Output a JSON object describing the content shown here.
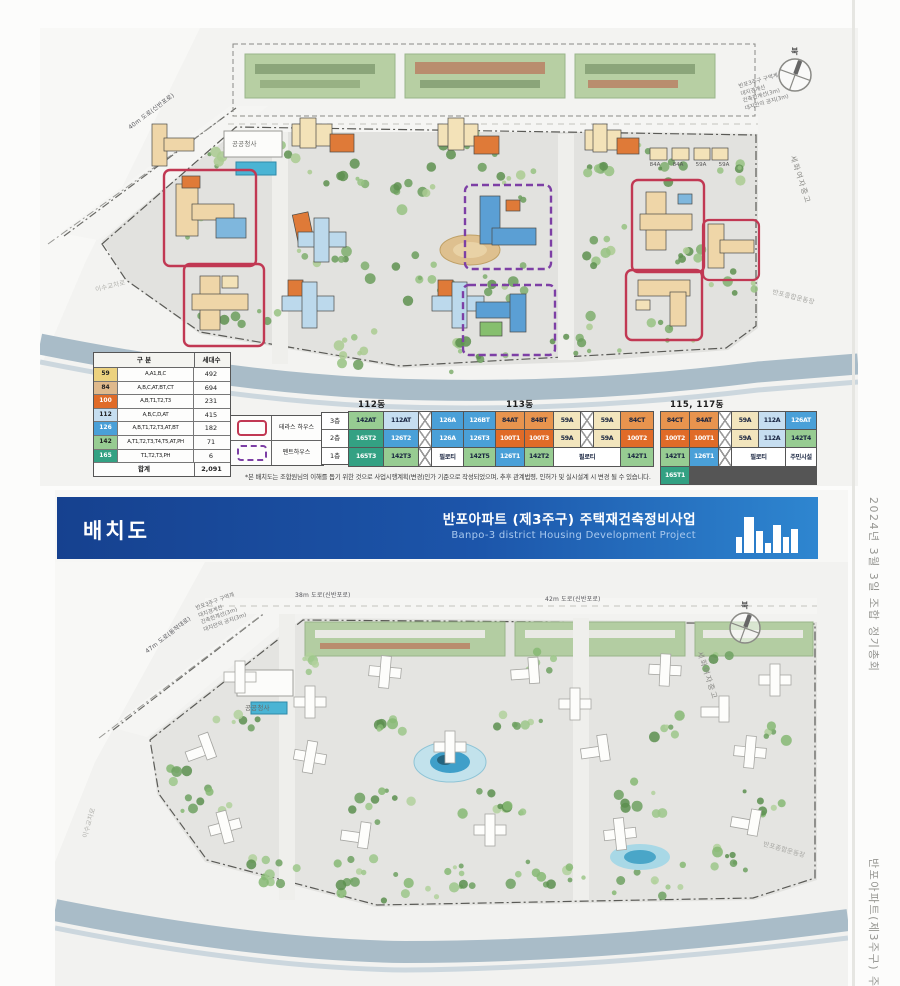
{
  "colors": {
    "terrace_outline": "#c13853",
    "penthouse_outline": "#7d3fa5",
    "banner_start": "#16418f",
    "banner_end": "#2e86d0",
    "unit_colors": {
      "59": "#f2e5bd",
      "84": "#e8944e",
      "100": "#e06b28",
      "112": "#c6def0",
      "126": "#4aa0d8",
      "142": "#97cc92",
      "165": "#33a183",
      "plain": "#ffffff"
    },
    "light_text_kinds": [
      "100",
      "126",
      "165"
    ]
  },
  "side_text": {
    "top": "2024년 3월 3일 조합 정기총회",
    "bottom": "반포아파트(제3주구) 주택재"
  },
  "top_plan": {
    "compass_label": "북",
    "labels": {
      "public_building": "공공청사",
      "road_diagonal": "40m 도로(신반포로)",
      "school": "세화여자중고",
      "interchange": "이수교차로",
      "sports": "반포종합운동장"
    },
    "mini_building_labels": [
      "84A",
      "84A",
      "59A",
      "59A"
    ],
    "annotations": [
      "반포3주구 구역계",
      "대지경계선",
      "건축한계선(3m)",
      "대지안의 공지(3m)"
    ],
    "legend_table": {
      "header_type": "구 분",
      "header_count": "세대수",
      "rows": [
        {
          "type": "59",
          "swatch": "#ecd27f",
          "desc": "A,A1,B,C",
          "count": "492",
          "light": false
        },
        {
          "type": "84",
          "swatch": "#dfb98c",
          "desc": "A,B,C,AT,BT,CT",
          "count": "694",
          "light": false
        },
        {
          "type": "100",
          "swatch": "#e06b28",
          "desc": "A,B,T1,T2,T3",
          "count": "231",
          "light": true
        },
        {
          "type": "112",
          "swatch": "#c6def0",
          "desc": "A,B,C,D,AT",
          "count": "415",
          "light": false
        },
        {
          "type": "126",
          "swatch": "#4aa0d8",
          "desc": "A,B,T1,T2,T3,AT,BT",
          "count": "182",
          "light": true
        },
        {
          "type": "142",
          "swatch": "#97cc92",
          "desc": "A,T1,T2,T3,T4,T5,AT,PH",
          "count": "71",
          "light": false
        },
        {
          "type": "165",
          "swatch": "#33a183",
          "desc": "T1,T2,T3,PH",
          "count": "6",
          "light": true
        }
      ],
      "total_label": "합계",
      "total_count": "2,091"
    },
    "outline_legend": [
      {
        "label": "테라스 하우스"
      },
      {
        "label": "펜트하우스"
      }
    ],
    "floors": [
      "3층",
      "2층",
      "1층"
    ],
    "unit_tables": [
      {
        "title": "112동",
        "cols": "34px 34px 12px 31px 31px",
        "rows": [
          [
            {
              "t": "142AT",
              "k": "142"
            },
            {
              "t": "112AT",
              "k": "112"
            },
            {
              "g": 1
            },
            {
              "t": "126A",
              "k": "126"
            },
            {
              "t": "126BT",
              "k": "126"
            }
          ],
          [
            {
              "t": "165T2",
              "k": "165"
            },
            {
              "t": "126T2",
              "k": "126"
            },
            {
              "g": 1
            },
            {
              "t": "126A",
              "k": "126"
            },
            {
              "t": "126T3",
              "k": "126"
            }
          ],
          [
            {
              "t": "165T3",
              "k": "165"
            },
            {
              "t": "142T3",
              "k": "142"
            },
            {
              "g": 1
            },
            {
              "t": "필로티",
              "k": "plain"
            },
            {
              "t": "142T5",
              "k": "142"
            }
          ]
        ]
      },
      {
        "title": "113동",
        "cols": "28px 28px 26px 12px 26px 32px",
        "rows": [
          [
            {
              "t": "84AT",
              "k": "84"
            },
            {
              "t": "84BT",
              "k": "84"
            },
            {
              "t": "59A",
              "k": "59"
            },
            {
              "g": 1
            },
            {
              "t": "59A",
              "k": "59"
            },
            {
              "t": "84CT",
              "k": "84"
            }
          ],
          [
            {
              "t": "100T1",
              "k": "100"
            },
            {
              "t": "100T3",
              "k": "100"
            },
            {
              "t": "59A",
              "k": "59"
            },
            {
              "g": 1
            },
            {
              "t": "59A",
              "k": "59"
            },
            {
              "t": "100T2",
              "k": "100"
            }
          ],
          [
            {
              "t": "126T1",
              "k": "126"
            },
            {
              "t": "142T2",
              "k": "142"
            },
            {
              "t": "필로티",
              "k": "plain",
              "span": 3
            },
            {
              "t": "142T1",
              "k": "142"
            }
          ]
        ]
      },
      {
        "title": "115, 117동",
        "cols": "28px 28px 12px 26px 26px 30px",
        "rows": [
          [
            {
              "t": "84CT",
              "k": "84"
            },
            {
              "t": "84AT",
              "k": "84"
            },
            {
              "g": 1
            },
            {
              "t": "59A",
              "k": "59"
            },
            {
              "t": "112A",
              "k": "112"
            },
            {
              "t": "126AT",
              "k": "126"
            }
          ],
          [
            {
              "t": "100T2",
              "k": "100"
            },
            {
              "t": "100T1",
              "k": "100"
            },
            {
              "g": 1
            },
            {
              "t": "59A",
              "k": "59"
            },
            {
              "t": "112A",
              "k": "112"
            },
            {
              "t": "142T4",
              "k": "142"
            }
          ],
          [
            {
              "t": "142T1",
              "k": "142"
            },
            {
              "t": "126T1",
              "k": "126"
            },
            {
              "g": 1
            },
            {
              "t": "필로티",
              "k": "plain",
              "span": 2
            },
            {
              "t": "주민시설",
              "k": "plain"
            },
            {
              "t": "165T1",
              "k": "165"
            }
          ]
        ]
      }
    ],
    "footnote": "*본 배치도는 조합원님의 이해를 돕기 위한 것으로 사업시행계획(변경)인가 기준으로 작성되었으며, 추후 관계법령, 인허가 및 실시설계 시 변경 될 수 있습니다."
  },
  "bottom_plan": {
    "header": {
      "title": "배치도",
      "project_ko": "반포아파트 (제3주구) 주택재건축정비사업",
      "project_en": "Banpo-3 district Housing Development Project"
    },
    "compass_label": "북",
    "labels": {
      "road_38": "38m 도로(신반포로)",
      "road_42": "42m 도로(신반포로)",
      "road_diagonal": "47m 도로(동작대로)",
      "public_building": "공공청사",
      "school": "세화여자중고",
      "interchange": "이수교차로",
      "sports": "반포종합운동장"
    },
    "annotations": [
      "반포3주구 구역계",
      "대지경계선",
      "건축한계선(3m)",
      "대지안의 공지(3m)"
    ]
  }
}
